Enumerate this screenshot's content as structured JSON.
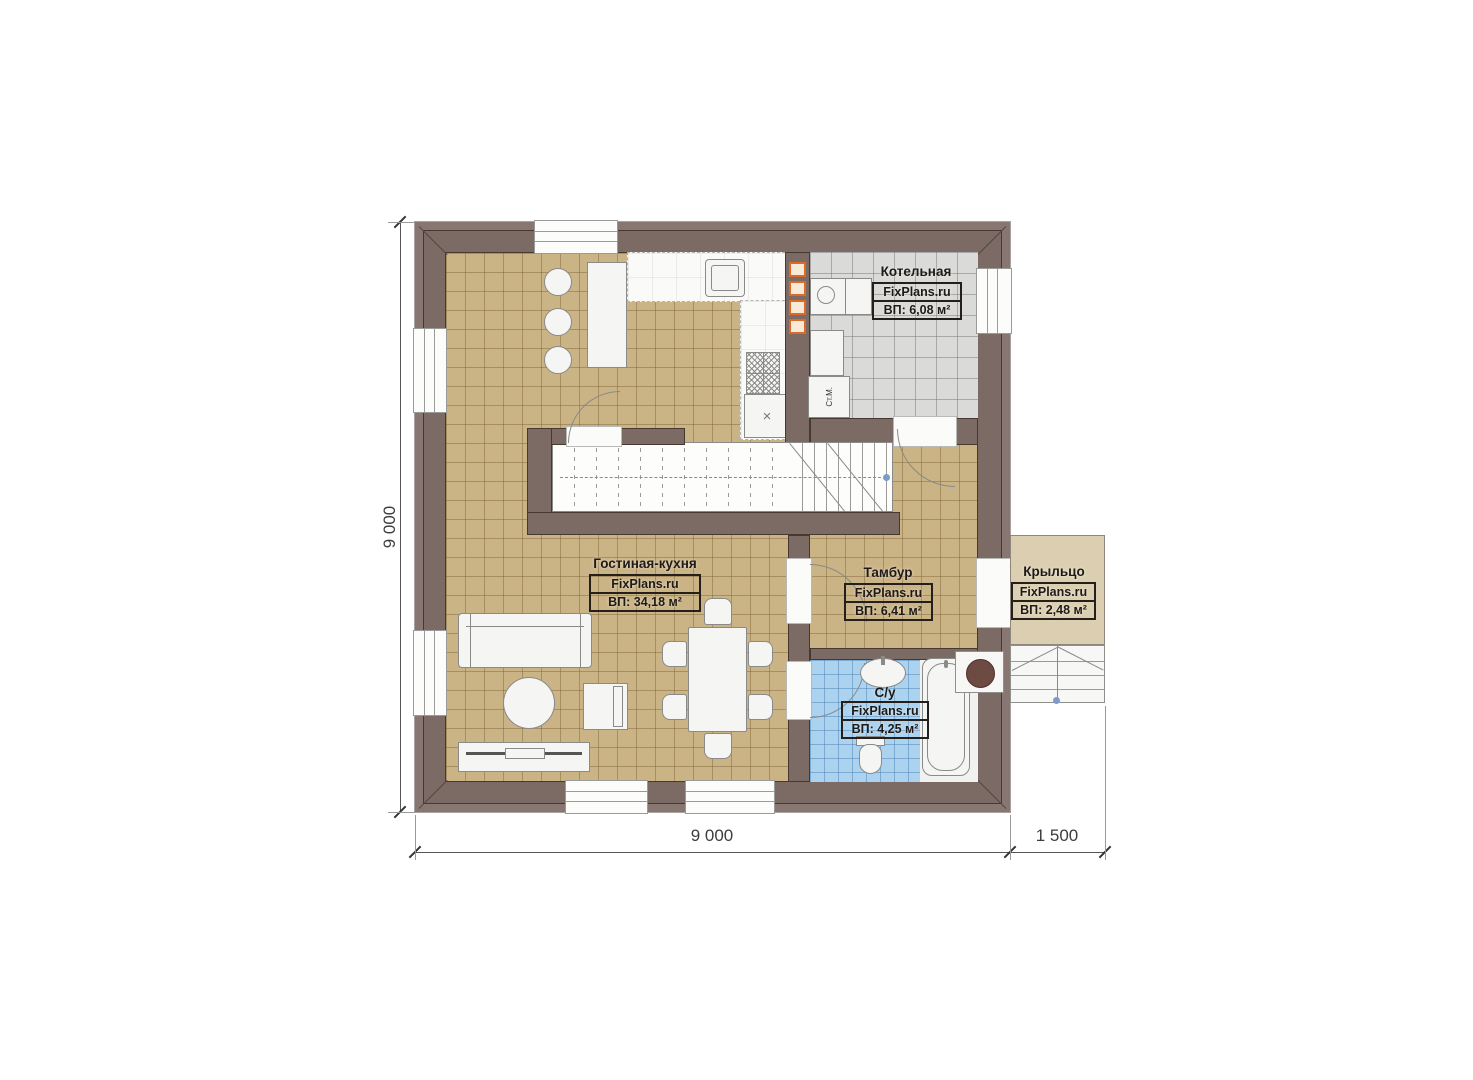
{
  "plan": {
    "rooms": [
      {
        "name": "Гостиная-кухня",
        "brand": "FixPlans.ru",
        "area": "ВП: 34,18 м²"
      },
      {
        "name": "Тамбур",
        "brand": "FixPlans.ru",
        "area": "ВП: 6,41 м²"
      },
      {
        "name": "С/у",
        "brand": "FixPlans.ru",
        "area": "ВП: 4,25 м²"
      },
      {
        "name": "Котельная",
        "brand": "FixPlans.ru",
        "area": "ВП: 6,08 м²"
      },
      {
        "name": "Крыльцо",
        "brand": "FixPlans.ru",
        "area": "ВП: 2,48 м²"
      }
    ],
    "dimensions": {
      "left": "9 000",
      "bottom": "9 000",
      "bottom_porch": "1 500"
    },
    "labels": {
      "washing_machine": "Ст.М.",
      "stove_cabinet_mark": "×"
    },
    "colors": {
      "wall": "#7c6a65",
      "wall_outer": "#887672",
      "floor_beige": "#cab385",
      "tile_gray": "#dadad8",
      "tile_blue": "#abd3f0",
      "porch": "#dccfb1",
      "vent_orange": "#dc6a28",
      "dot_blue": "#7b9cc9"
    }
  }
}
